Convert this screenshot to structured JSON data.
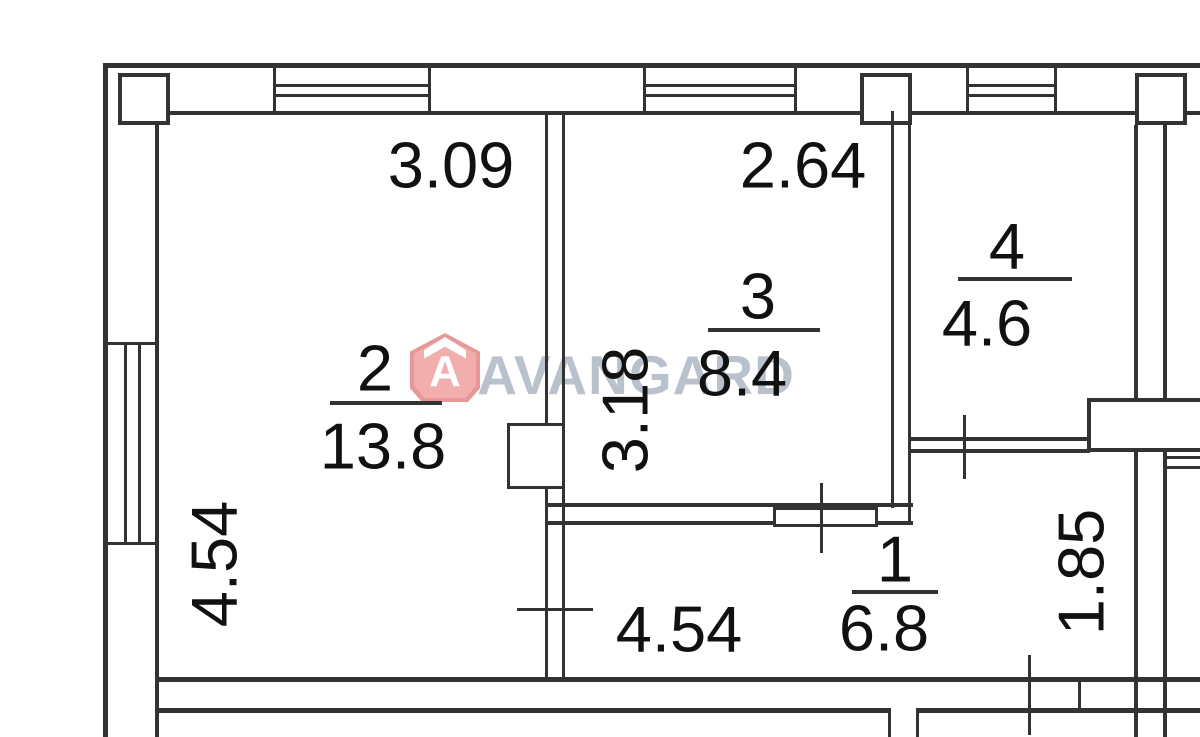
{
  "plan": {
    "rooms": [
      {
        "number": "1",
        "area": "6.8"
      },
      {
        "number": "2",
        "area": "13.8"
      },
      {
        "number": "3",
        "area": "8.4"
      },
      {
        "number": "4",
        "area": "4.6"
      }
    ],
    "dimensions": {
      "room2_width": "3.09",
      "room3_width": "2.64",
      "room2_height": "4.54",
      "room3_height": "3.18",
      "corridor_width": "4.54",
      "right_nook_height": "1.85"
    }
  },
  "watermark": {
    "brand": "AVANGARD",
    "logo_letter": "A",
    "brand_color": "#b9c2cc",
    "logo_color": "#f0a6a6"
  },
  "colors": {
    "line": "#333333",
    "background": "#ffffff",
    "label_text": "#111111"
  }
}
